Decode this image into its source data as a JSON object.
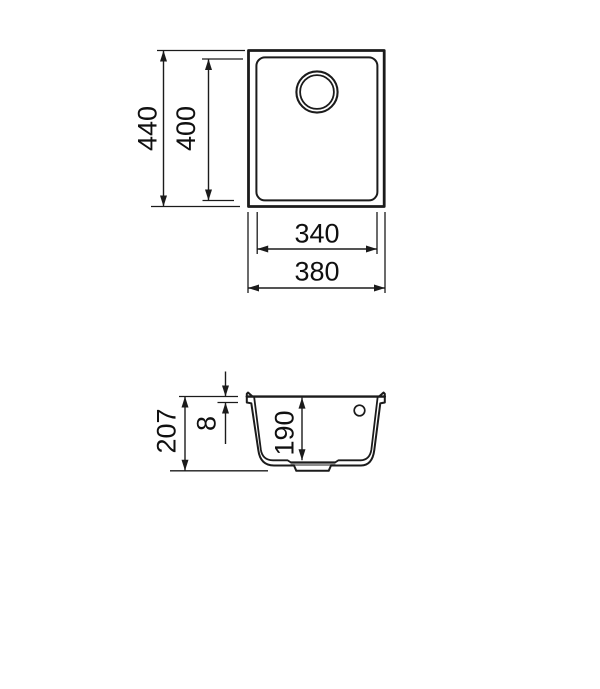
{
  "drawing": {
    "title": "sink-dimensions-technical-drawing",
    "views": {
      "top_view": {
        "overall_height_mm": "440",
        "basin_height_mm": "400",
        "basin_width_mm": "340",
        "overall_width_mm": "380"
      },
      "section_view": {
        "overall_depth_mm": "207",
        "rim_thickness_mm": "8",
        "basin_depth_mm": "190"
      }
    },
    "colors": {
      "background": "#ffffff",
      "line": "#1b1b1b",
      "drain_recess_fill": "#8d8d8d"
    }
  }
}
